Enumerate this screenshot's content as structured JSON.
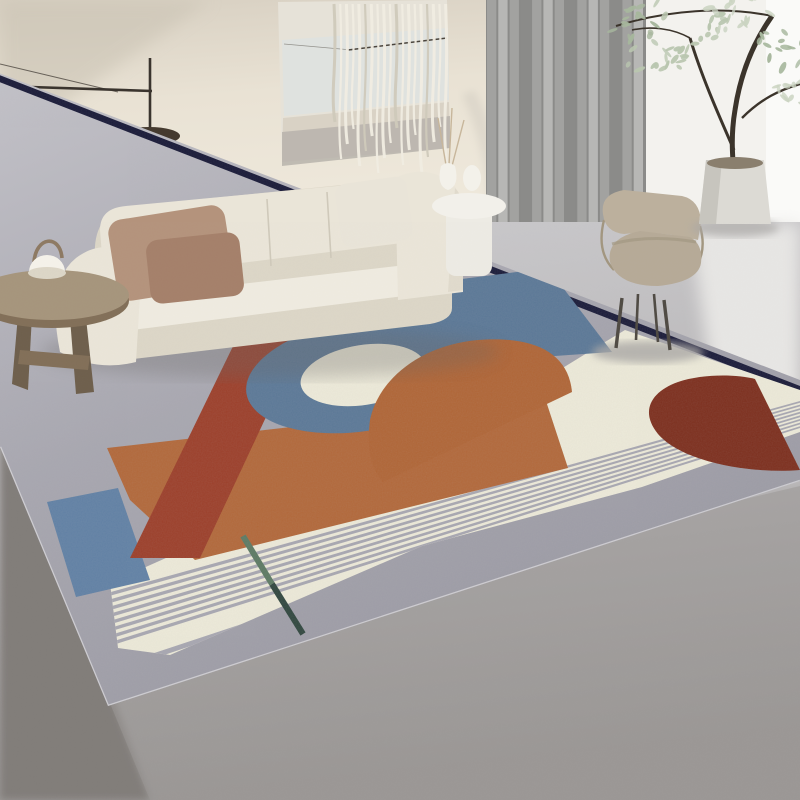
{
  "meta": {
    "description": "Lifestyle product photo of a modern geometric area rug in a bright living room with cream modular sofa, arched floor lamp, gray curtain, lounge chair and potted tree",
    "image_type": "natural-image / product photo",
    "visible_text": ""
  },
  "palette": {
    "wall_top": "#d7cfc1",
    "wall_mid": "#e9e2d4",
    "wall_low": "#efe9dc",
    "wall_corner_shadow": "#c9c2b3",
    "wall_white": "#f3f2ee",
    "window_light": "#fafaf8",
    "floor_light": "#cbcacd",
    "floor_mid": "#b7b5b6",
    "floor_near": "#9b9896",
    "floor_dark_wedge": "#817d79",
    "floor_pool": "#e7e6e4",
    "baseboard": "#bab4a9",
    "artwork_bg": "#e6e2d8",
    "artwork_sky": "#dde2e1",
    "artwork_sand": "#d9d2c5",
    "artwork_band": "#b7b3ab",
    "artwork_line": "#4a443c",
    "macrame_light": "#f0ece2",
    "macrame_dark": "#cfc9ba",
    "lamp_metal": "#3a342e",
    "lamp_shade": "#453a2f",
    "lamp_glow": "#f8f4e9",
    "curtain_dark": "#8b8b89",
    "curtain_mid": "#a3a3a1",
    "curtain_light": "#b9b9b7",
    "curtain_shadow": "#78787б",
    "sofa_body": "#eae5d8",
    "sofa_shade": "#dcd6c7",
    "sofa_seat": "#efebe0",
    "sofa_seam": "#cfc9ba",
    "sofa_under": "#8f8b84",
    "pillow_tan": "#b4937c",
    "pillow_brown": "#a5806a",
    "pillow_white": "#e9e4d8",
    "wood_top": "#a6957c",
    "wood_side": "#826f58",
    "wood_leg": "#6e5f4c",
    "tablelamp_body": "#f5f2ea",
    "tablelamp_handle": "#8d7962",
    "white_table": "#edebe4",
    "white_table_top": "#f2f0ea",
    "vase_white": "#f3f1ea",
    "dried_grass": "#c7b69b",
    "chair_seat": "#b6aa97",
    "chair_back": "#bcb09d",
    "chair_back_shade": "#a2967f",
    "chair_leg": "#4f4a43",
    "chair_shadow": "#aaa8a6",
    "planter": "#dcdad4",
    "planter_side": "#c7c5be",
    "soil": "#8a7f6e",
    "trunk": "#3b342b",
    "leaf_a": "#b9c6af",
    "leaf_b": "#cbd4c2",
    "leaf_c": "#a7b79d",
    "rug_gray_far": "#c6c5cb",
    "rug_gray": "#a8a7b0",
    "rug_gray_near": "#9897a1",
    "rug_cream": "#edead9",
    "rug_stripe": "#a8a7b1",
    "rug_blue": "#5b7897",
    "rug_blue_rect": "#6181a5",
    "rug_orange": "#b2683a",
    "rug_dome": "#b06536",
    "rug_brick": "#9c3f2a",
    "rug_maroon": "#7d2f1e",
    "rug_navy": "#1a1b39",
    "rug_teal": "#5d7a63",
    "rug_teal_dark": "#31473f",
    "rug_edge": "#d9d8dc",
    "shadow_soft": "#6b6866"
  },
  "scene": {
    "rug": {
      "style": "morandi geometric",
      "elements": [
        "slate-blue arch band",
        "cream sun circle",
        "navy pinstripe",
        "brick red diagonal stripe",
        "burnt orange block",
        "orange dome",
        "maroon half circle",
        "pinstriped cream band",
        "blue-gray block",
        "teal accent line"
      ],
      "stripes_dense": 8,
      "stripes_sparse": 4
    },
    "macrame": {
      "strands": 19
    },
    "curtain": {
      "folds": 14
    },
    "plant": {
      "leaves": 95
    },
    "sofa": {
      "seats": 4,
      "pillows": 3
    }
  }
}
